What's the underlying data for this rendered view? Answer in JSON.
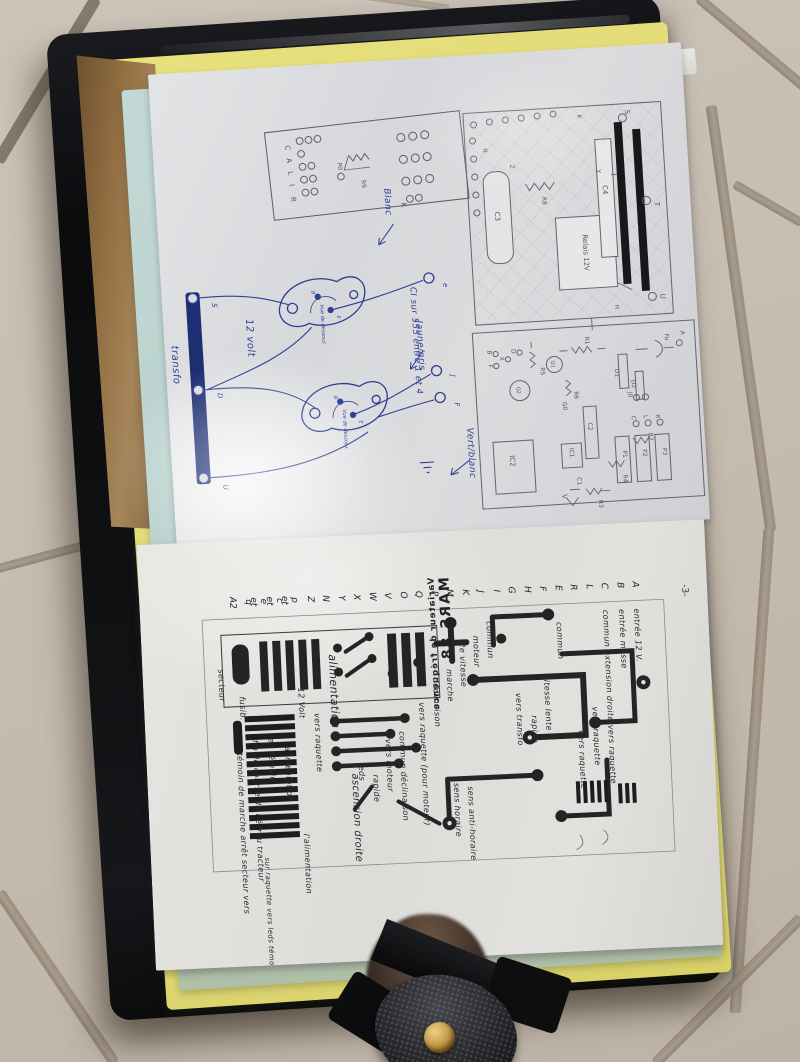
{
  "colors": {
    "tile": "#c7beb2",
    "grout": "#a3988a",
    "binder_black": "#0d0e10",
    "folder_yellow": "#ddd66e",
    "sheet_cyan": "#b9d2cd",
    "page_white": "#dcdcdf",
    "ink_blue": "#2c3f93",
    "pencil_grey": "#55555b",
    "toner_black": "#222225",
    "brass": "#c69d4c"
  },
  "top_page": {
    "terminal_box": {
      "letters": [
        "C",
        "A",
        "L",
        "I",
        "R"
      ],
      "k_label": "K",
      "r9": "R9",
      "p0": "P0"
    },
    "blue_drawing": {
      "transfo_label": "transfo",
      "voltage_label": "12 volt",
      "bar_terminals": [
        "S",
        "D",
        "U"
      ],
      "out_terminals": [
        "e",
        "J",
        "F"
      ],
      "package_note": "Vue de dessous",
      "pin_b": "B",
      "pin_e": "E",
      "wire_colors": [
        "Blanc",
        "Jaune/gris",
        "Vert/blanc"
      ],
      "ic_note": "CI sur 555 entre 1 et 4"
    },
    "pencil_schematic": {
      "relay_label": "Relais 12V",
      "bar_terminals": [
        "S",
        "T",
        "U"
      ],
      "parts": [
        "C3",
        "R8",
        "C4",
        "Fu",
        "R1",
        "R5",
        "R6",
        "D1",
        "D2",
        "Q1",
        "Q2",
        "C2",
        "IC2",
        "IC1",
        "J0",
        "G0",
        "R2",
        "R3",
        "R4",
        "P1",
        "P2",
        "P3",
        "C1",
        "V"
      ],
      "edge_letters": [
        "K",
        "Y",
        "N",
        "Z",
        "H",
        "A",
        "B",
        "F",
        "X",
        "D",
        "C",
        "L",
        "R"
      ]
    }
  },
  "bottom_page": {
    "pcb_title_line1": "Variateur de fréquence",
    "pcb_title_line2": "MARS 88",
    "page_number": "-3-",
    "connector_letters": [
      "A2",
      "q",
      "e et",
      "c et",
      "p et",
      "Z",
      "N",
      "Y",
      "X",
      "W",
      "V",
      "O",
      "Q",
      "P",
      "M",
      "K",
      "J",
      "I",
      "G",
      "H",
      "F",
      "E",
      "R",
      "L",
      "C",
      "B",
      "A"
    ],
    "annotations": [
      "entrée 12 V.",
      "entrée masse",
      "commun extension droite vers raquette",
      "vers raquette",
      "vers raquette",
      "commun",
      "vitesse lente",
      "rapide",
      "vers transfo",
      "commun",
      "moteur",
      "2e vitesse",
      "marche",
      "déclinaison",
      "vers raquette (pour moteur)",
      "sens horaire",
      "sens anti-horaire",
      "commun déclinaison",
      "vers moteur",
      "rapide",
      "leds",
      "alimentation",
      "ascension droite",
      "vers raquette",
      "12 Volt",
      "alimentation",
      "led témoin",
      "fin de course de l'écrou tracteur",
      "témoin de marche arrêt secteur vers",
      "l'alimentation",
      "sur raquette vers leds témoin de marche arrêt secteur",
      "secteur",
      "fusib."
    ]
  }
}
